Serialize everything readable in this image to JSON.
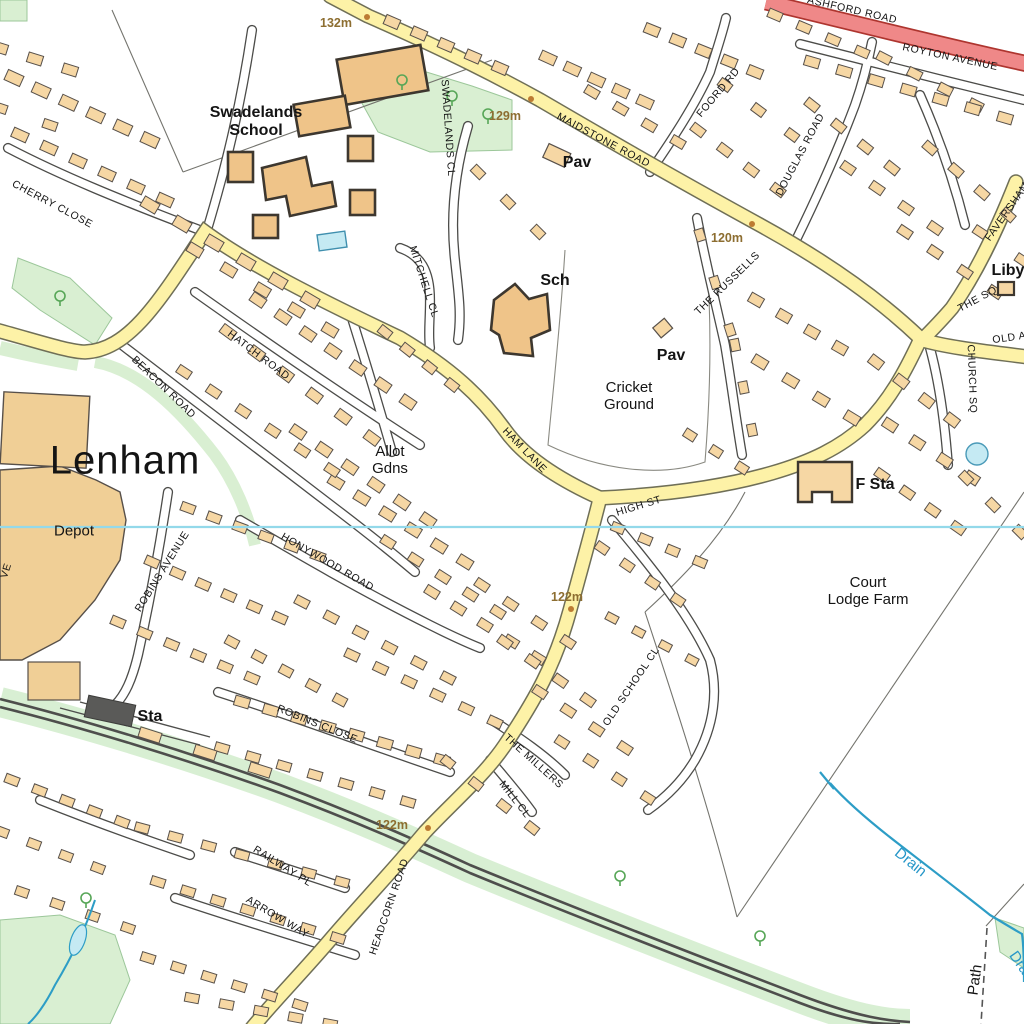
{
  "map": {
    "region_name": "Lenham",
    "colors": {
      "background": "#ffffff",
      "building_fill": "#f6d7a4",
      "building_stroke": "#57504a",
      "school_fill": "#efc489",
      "minor_road_fill": "#ffffff",
      "b_road_fill": "#fdf2a7",
      "a_road_fill": "#ef8888",
      "green_space": "#d9efd2",
      "railway": "#4e4e4c",
      "water": "#2d9dc6",
      "grid_line": "#93d9ea",
      "spot_height_text": "#8d6e31",
      "spot_height_dot": "#bc7b33"
    },
    "labels": [
      {
        "id": "ashford-road",
        "text": "ASHFORD ROAD",
        "x": 852,
        "y": 11,
        "rot": 13,
        "cls": "road"
      },
      {
        "id": "royton-avenue",
        "text": "ROYTON AVENUE",
        "x": 950,
        "y": 58,
        "rot": 12,
        "cls": "road"
      },
      {
        "id": "foord-rd",
        "text": "FOORD RD",
        "x": 719,
        "y": 93,
        "rot": -50,
        "cls": "road"
      },
      {
        "id": "maidstone-road",
        "text": "MAIDSTONE ROAD",
        "x": 603,
        "y": 141,
        "rot": 28,
        "cls": "road"
      },
      {
        "id": "douglas-road",
        "text": "DOUGLAS ROAD",
        "x": 801,
        "y": 155,
        "rot": -62,
        "cls": "road"
      },
      {
        "id": "faversham-road",
        "text": "FAVERSHAM",
        "x": 1008,
        "y": 212,
        "rot": -55,
        "cls": "road"
      },
      {
        "id": "the-sq",
        "text": "THE SQ",
        "x": 978,
        "y": 300,
        "rot": -28,
        "cls": "road"
      },
      {
        "id": "old-ashford-road",
        "text": "OLD ASHFORD RD",
        "x": 1043,
        "y": 334,
        "rot": -8,
        "cls": "road"
      },
      {
        "id": "church-sq",
        "text": "CHURCH SQ",
        "x": 971,
        "y": 379,
        "rot": 88,
        "cls": "road"
      },
      {
        "id": "liby",
        "text": "Liby",
        "x": 1008,
        "y": 271,
        "rot": 0,
        "cls": "placeb"
      },
      {
        "id": "swadelands-school",
        "text": "Swadelands\nSchool",
        "x": 256,
        "y": 122,
        "rot": 0,
        "cls": "placeb"
      },
      {
        "id": "swadelands-cl",
        "text": "SWADELANDS CL",
        "x": 447,
        "y": 128,
        "rot": 86,
        "cls": "road"
      },
      {
        "id": "mitchell-cl",
        "text": "MITCHELL CL",
        "x": 423,
        "y": 282,
        "rot": 72,
        "cls": "road"
      },
      {
        "id": "pav-north",
        "text": "Pav",
        "x": 577,
        "y": 163,
        "rot": 0,
        "cls": "placeb"
      },
      {
        "id": "sch",
        "text": "Sch",
        "x": 555,
        "y": 281,
        "rot": 0,
        "cls": "placeb"
      },
      {
        "id": "pav-cricket",
        "text": "Pav",
        "x": 671,
        "y": 356,
        "rot": 0,
        "cls": "placeb"
      },
      {
        "id": "cricket-ground",
        "text": "Cricket\nGround",
        "x": 629,
        "y": 397,
        "rot": 0,
        "cls": "place"
      },
      {
        "id": "the-russells",
        "text": "THE RUSSELLS",
        "x": 728,
        "y": 284,
        "rot": -44,
        "cls": "road"
      },
      {
        "id": "cherry-close",
        "text": "CHERRY CLOSE",
        "x": 52,
        "y": 205,
        "rot": 28,
        "cls": "road"
      },
      {
        "id": "hatch-road",
        "text": "HATCH ROAD",
        "x": 258,
        "y": 356,
        "rot": 37,
        "cls": "road"
      },
      {
        "id": "beacon-road",
        "text": "BEACON ROAD",
        "x": 163,
        "y": 388,
        "rot": 44,
        "cls": "road"
      },
      {
        "id": "lenham",
        "text": "Lenham",
        "x": 125,
        "y": 461,
        "rot": 0,
        "cls": "town"
      },
      {
        "id": "depot",
        "text": "Depot",
        "x": 74,
        "y": 532,
        "rot": 0,
        "cls": "place"
      },
      {
        "id": "robins-avenue",
        "text": "ROBINS AVENUE",
        "x": 163,
        "y": 572,
        "rot": -58,
        "cls": "road"
      },
      {
        "id": "honywood-road",
        "text": "HONYWOOD ROAD",
        "x": 327,
        "y": 563,
        "rot": 30,
        "cls": "road"
      },
      {
        "id": "allot-gdns",
        "text": "Allot\nGdns",
        "x": 390,
        "y": 461,
        "rot": 0,
        "cls": "place"
      },
      {
        "id": "ham-lane",
        "text": "HAM LANE",
        "x": 524,
        "y": 451,
        "rot": 46,
        "cls": "road"
      },
      {
        "id": "high-st",
        "text": "HIGH ST",
        "x": 639,
        "y": 507,
        "rot": -17,
        "cls": "road"
      },
      {
        "id": "f-sta",
        "text": "F Sta",
        "x": 875,
        "y": 485,
        "rot": 0,
        "cls": "placeb"
      },
      {
        "id": "court-lodge-farm",
        "text": "Court\nLodge Farm",
        "x": 868,
        "y": 592,
        "rot": 0,
        "cls": "place"
      },
      {
        "id": "spot-132m",
        "text": "132m",
        "x": 336,
        "y": 23,
        "rot": 0,
        "cls": "spot"
      },
      {
        "id": "spot-129m",
        "text": "129m",
        "x": 505,
        "y": 116,
        "rot": 0,
        "cls": "spot"
      },
      {
        "id": "spot-120m",
        "text": "120m",
        "x": 727,
        "y": 238,
        "rot": 0,
        "cls": "spot"
      },
      {
        "id": "spot-122m-high-st",
        "text": "122m",
        "x": 567,
        "y": 597,
        "rot": 0,
        "cls": "spot"
      },
      {
        "id": "spot-122m-headcorn",
        "text": "122m",
        "x": 392,
        "y": 825,
        "rot": 0,
        "cls": "spot"
      },
      {
        "id": "sta",
        "text": "Sta",
        "x": 150,
        "y": 717,
        "rot": 0,
        "cls": "placeb"
      },
      {
        "id": "robins-close",
        "text": "ROBINS CLOSE",
        "x": 317,
        "y": 725,
        "rot": 22,
        "cls": "road"
      },
      {
        "id": "railway-pl",
        "text": "RAILWAY PL",
        "x": 282,
        "y": 867,
        "rot": 32,
        "cls": "road"
      },
      {
        "id": "arrow-way",
        "text": "ARROW WAY",
        "x": 277,
        "y": 918,
        "rot": 31,
        "cls": "road"
      },
      {
        "id": "headcorn-road",
        "text": "HEADCORN ROAD",
        "x": 390,
        "y": 907,
        "rot": -71,
        "cls": "road"
      },
      {
        "id": "the-millers",
        "text": "THE MILLERS",
        "x": 533,
        "y": 762,
        "rot": 42,
        "cls": "road"
      },
      {
        "id": "mill-cl",
        "text": "MILL CL",
        "x": 514,
        "y": 800,
        "rot": 52,
        "cls": "road"
      },
      {
        "id": "old-school-cl",
        "text": "OLD SCHOOL CL",
        "x": 632,
        "y": 687,
        "rot": -56,
        "cls": "road"
      },
      {
        "id": "drain",
        "text": "Drain",
        "x": 910,
        "y": 863,
        "rot": 39,
        "cls": "water"
      },
      {
        "id": "drain-edge",
        "text": "Drain",
        "x": 1022,
        "y": 968,
        "rot": 55,
        "cls": "water"
      },
      {
        "id": "path",
        "text": "Path",
        "x": 976,
        "y": 980,
        "rot": -82,
        "cls": "place"
      },
      {
        "id": "road-fragment-ve",
        "text": "VE",
        "x": 7,
        "y": 571,
        "rot": -72,
        "cls": "road"
      }
    ],
    "spot_dots": [
      {
        "x": 367,
        "y": 17
      },
      {
        "x": 531,
        "y": 99
      },
      {
        "x": 752,
        "y": 224
      },
      {
        "x": 571,
        "y": 609
      },
      {
        "x": 428,
        "y": 828
      }
    ]
  }
}
